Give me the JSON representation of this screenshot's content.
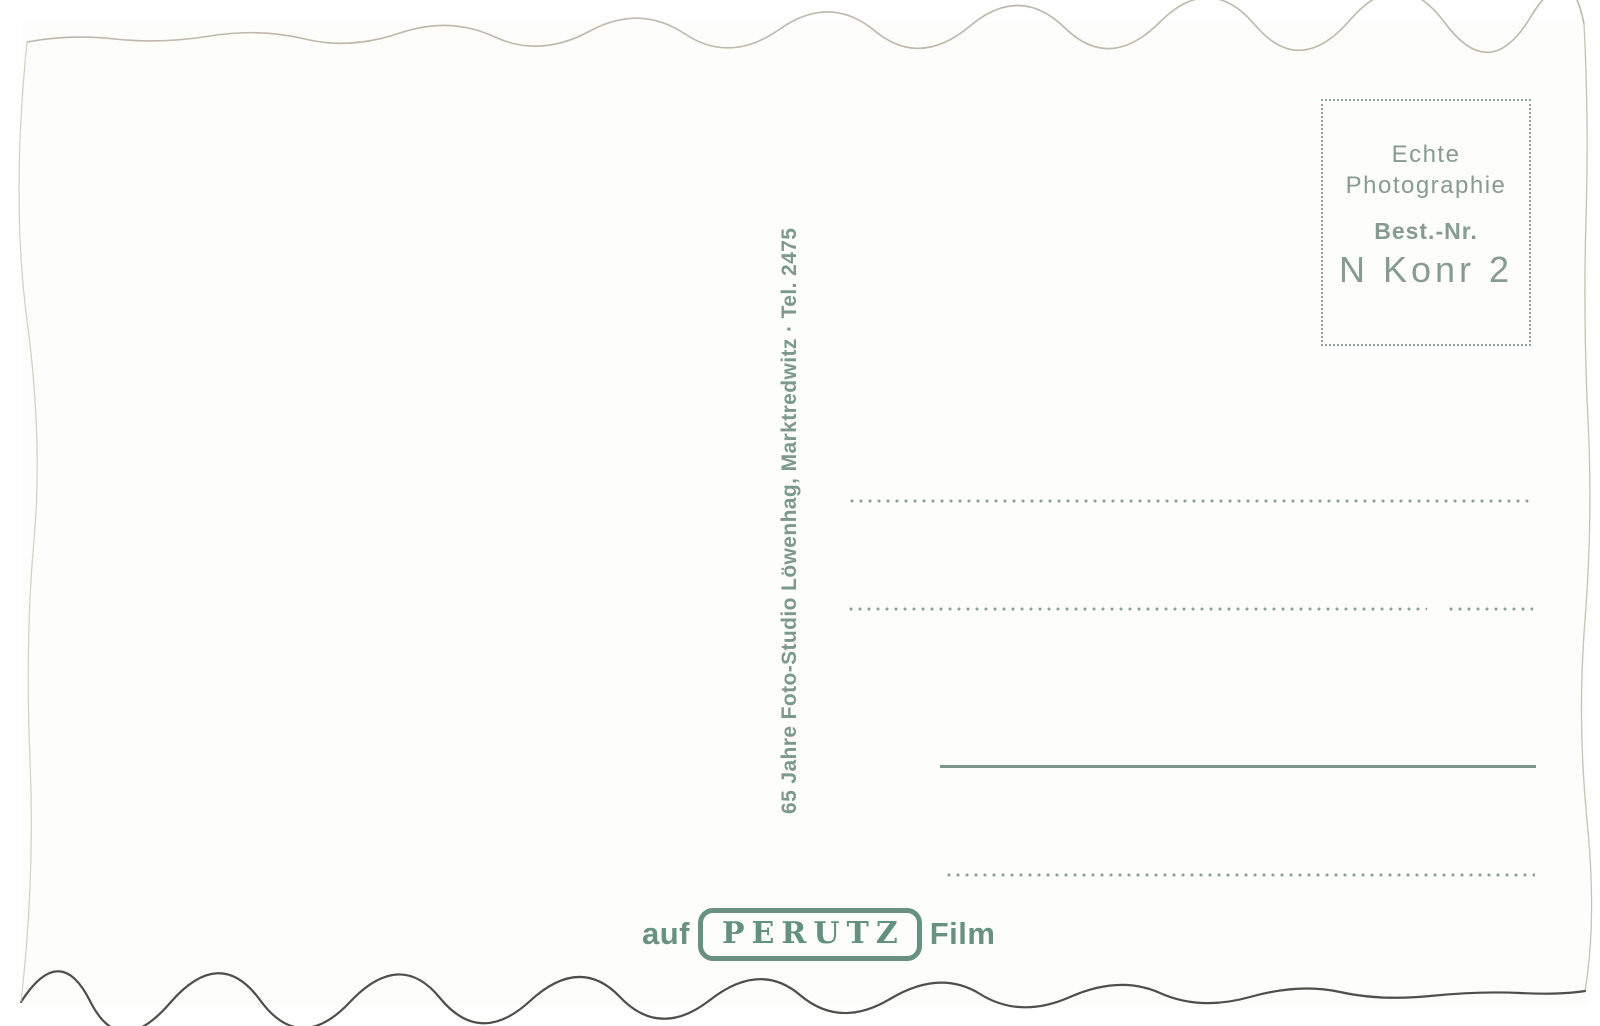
{
  "card": {
    "studio_imprint": "65 Jahre Foto-Studio Löwenhag, Marktredwitz · Tel. 2475",
    "info_box": {
      "line1": "Echte",
      "line2": "Photographie",
      "order_label": "Best.-Nr.",
      "order_number": "N Konr 2"
    },
    "film_imprint": {
      "prefix": "auf",
      "brand": "PERUTZ",
      "suffix": "Film"
    },
    "colors": {
      "ink_green": "#7d988d",
      "stamp_green": "#689181",
      "line_green": "#87a197",
      "card_white": "#fdfdfb",
      "bottom_edge_dark": "#4f4f4a"
    }
  }
}
